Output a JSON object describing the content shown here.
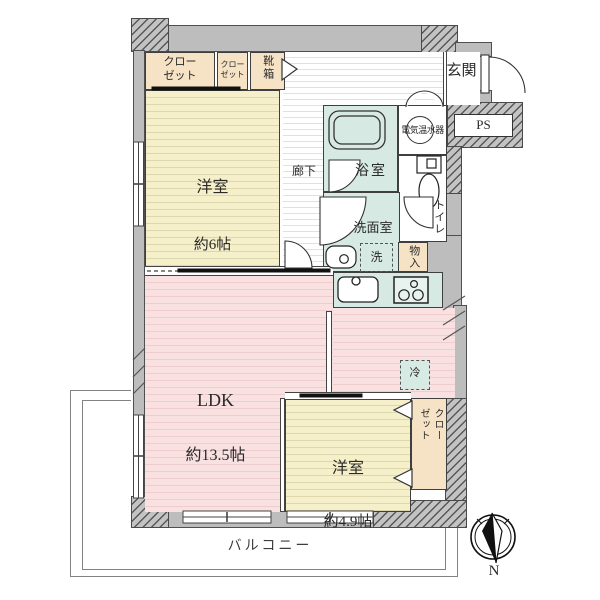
{
  "colors": {
    "wall_gray": "#bdbdbd",
    "room_yellow": "#f6f0ca",
    "room_pink": "#f9e0e1",
    "room_teal": "#d6e9e2",
    "closet_tan": "#f6e3c5"
  },
  "labels": {
    "closet_main": "クロー\nゼット",
    "closet_small": "クロー\nゼット",
    "shoe_box": "靴箱",
    "entrance": "玄関",
    "pipe_space": "PS",
    "water_heater": "電気温水器",
    "corridor": "廊下",
    "bathroom": "浴室",
    "washroom": "洗面室",
    "washer": "洗",
    "storage": "物入",
    "toilet": "トイレ",
    "bedroom1_name": "洋室",
    "bedroom1_size": "約6帖",
    "ldk_name": "LDK",
    "ldk_size": "約13.5帖",
    "fridge": "冷",
    "bedroom2_name": "洋室",
    "bedroom2_size": "約4.9帖",
    "closet_bedroom2": "クロー\nゼット",
    "balcony": "バルコニー",
    "compass_north": "N"
  }
}
